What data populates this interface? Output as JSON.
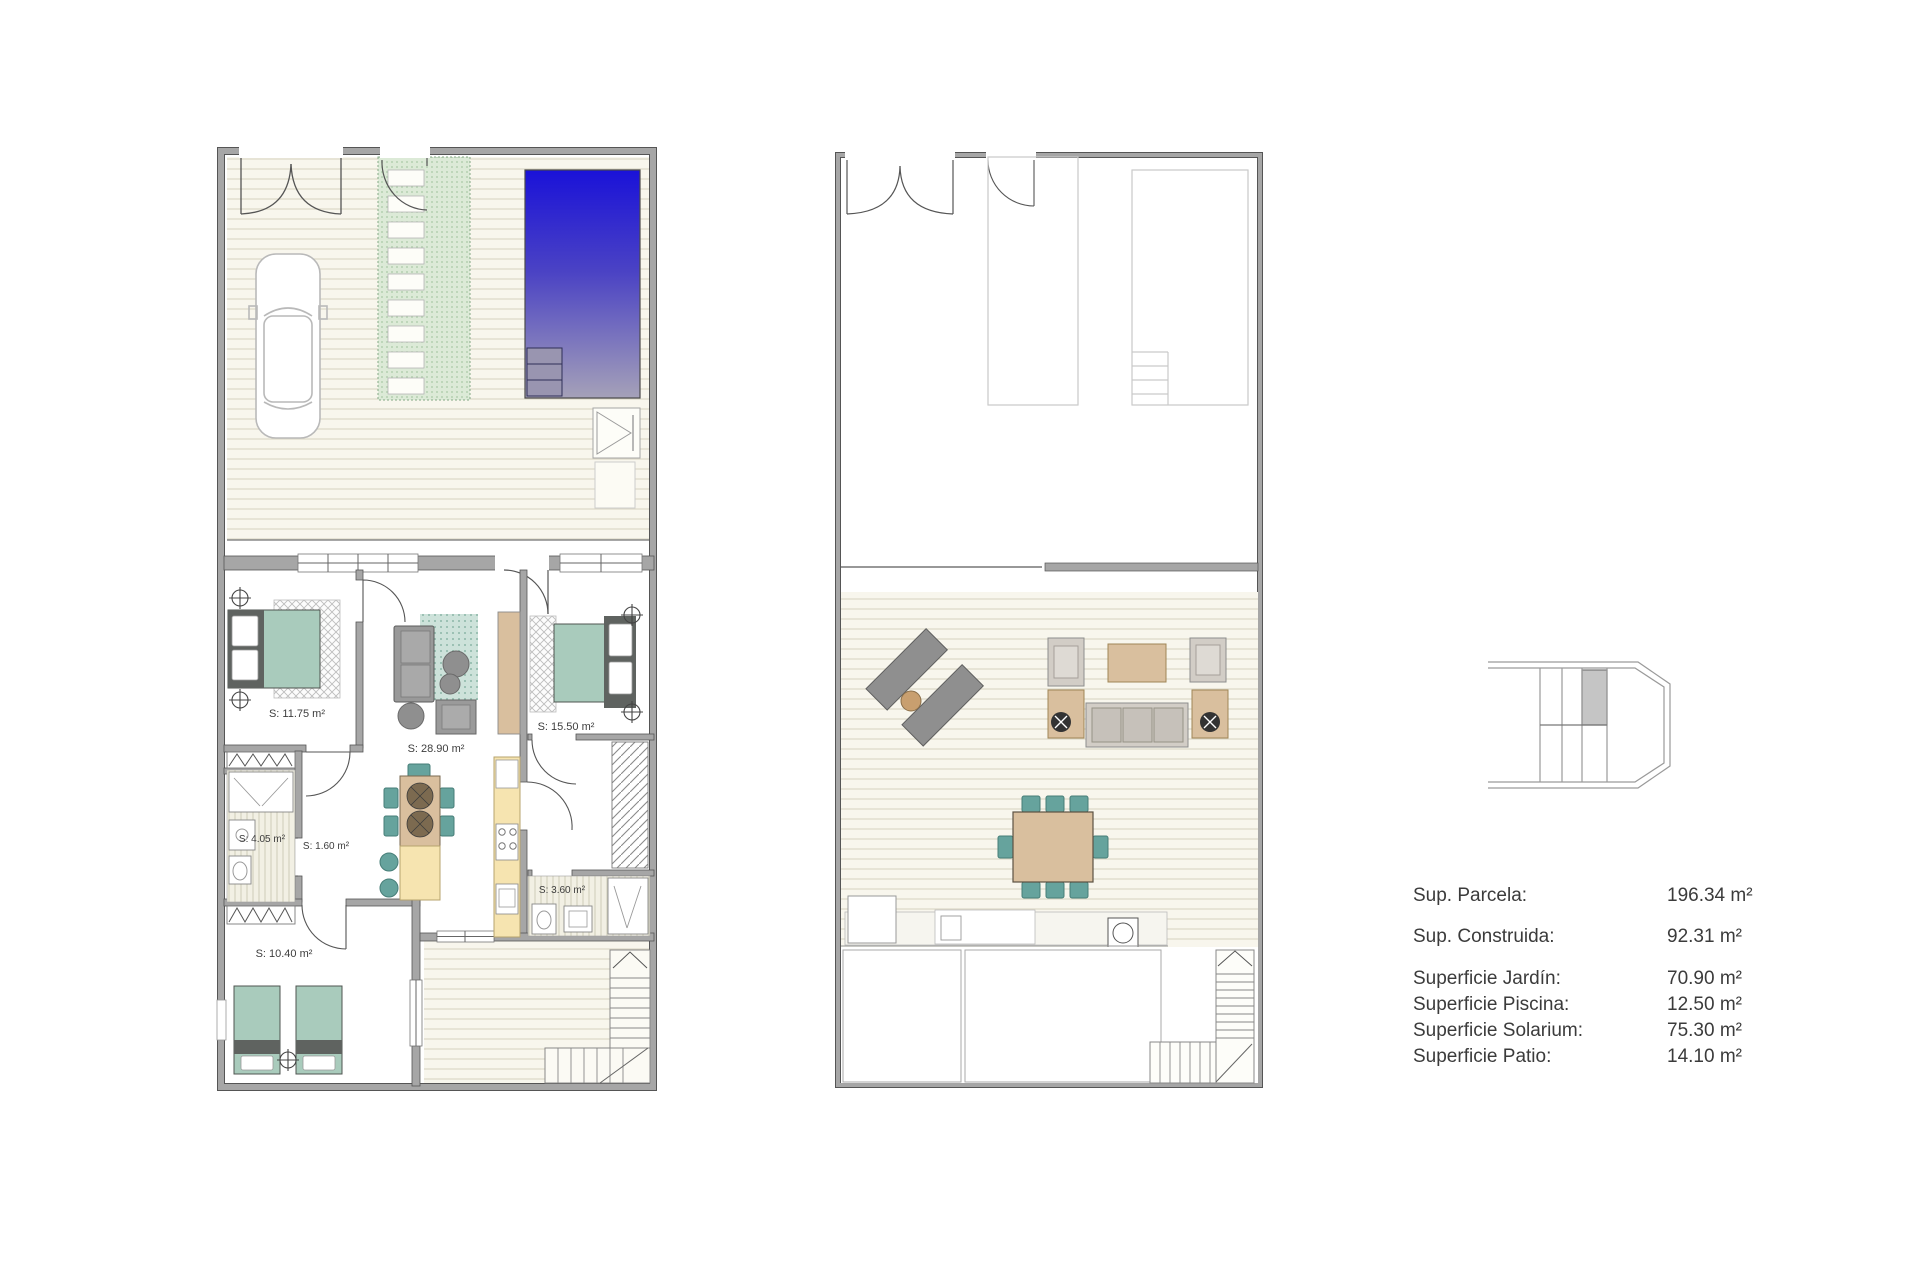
{
  "ground_floor": {
    "room_labels": {
      "bedroom_1": "S: 11.75 m²",
      "living_kitchen": "S: 28.90 m²",
      "bedroom_2": "S: 15.50 m²",
      "bathroom_1": "S: 4.05 m²",
      "hallway": "S: 1.60 m²",
      "bedroom_3": "S: 10.40 m²",
      "bathroom_2": "S: 3.60 m²"
    }
  },
  "legend": {
    "rows": [
      {
        "label": "Sup. Parcela:",
        "value": "196.34 m²"
      },
      {
        "label": "Sup. Construida:",
        "value": "92.31 m²"
      },
      {
        "label": "Superficie Jardín:",
        "value": "70.90 m²"
      },
      {
        "label": "Superficie Piscina:",
        "value": "12.50 m²"
      },
      {
        "label": "Superficie Solarium:",
        "value": "75.30 m²"
      },
      {
        "label": "Superficie Patio:",
        "value": "14.10 m²"
      }
    ]
  },
  "colors": {
    "wall_gray": "#a6a6a6",
    "wall_edge": "#555555",
    "deck_cream": "#f8f6ed",
    "deck_line": "#dcd8c6",
    "pool_blue_top": "#1a12d8",
    "pool_blue_bottom": "#a5a1b8",
    "path_green": "#dcead7",
    "furniture_teal_light": "#a9cbbc",
    "furniture_teal_dark": "#66a39d",
    "furniture_tan": "#d9bf9e",
    "furniture_gray": "#969696",
    "kitchen_yellow": "#f6e4b0",
    "keyplan_highlight": "#c5c5c5",
    "text": "#3b3b3b"
  }
}
